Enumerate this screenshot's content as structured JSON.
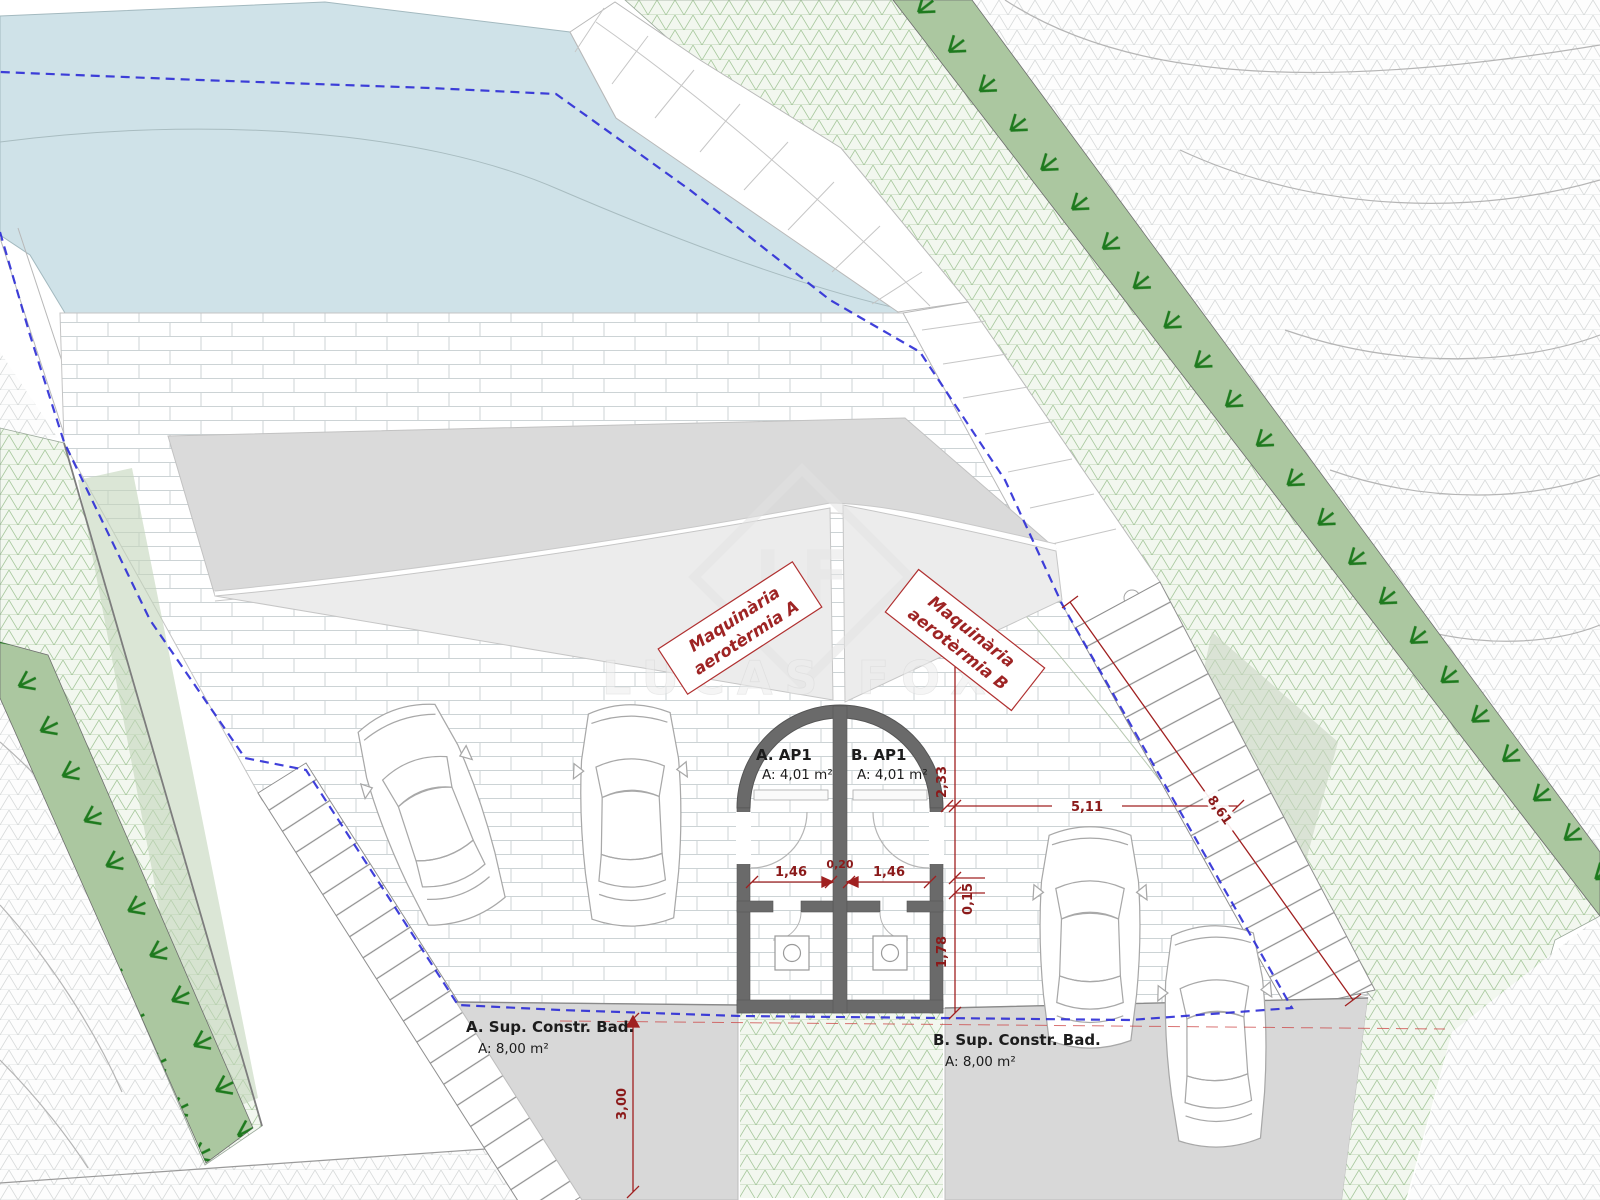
{
  "plan": {
    "watermark": {
      "logo": "LF",
      "brand": "LUCAS FOX"
    },
    "labels": {
      "machinery_a_line1": "Maquinària",
      "machinery_a_line2": "aerotèrmia A",
      "machinery_b_line1": "Maquinària",
      "machinery_b_line2": "aerotèrmia B",
      "room_a_name": "A. AP1",
      "room_a_area": "A: 4,01 m²",
      "room_b_name": "B. AP1",
      "room_b_area": "A: 4,01 m²",
      "surface_a_title": "A. Sup. Constr. Bad.",
      "surface_a_area": "A: 8,00 m²",
      "surface_b_title": "B. Sup. Constr. Bad.",
      "surface_b_area": "A: 8,00 m²"
    },
    "dimensions": {
      "terrace_width": "5,11",
      "stair_length": "8,61",
      "setback_depth": "2,33",
      "wall_gap": "0,15",
      "room_depth": "1,78",
      "room_a_width": "1,46",
      "wall_thickness": "0,20",
      "room_b_width": "1,46",
      "bottom_depth": "3,00"
    },
    "colors": {
      "pool": "#cfe2e8",
      "green_mesh_line": "#a6c89c",
      "green_mesh_bg": "#f2f7ef",
      "hedge_band": "#abc7a0",
      "hedge_feet": "#1e7a1e",
      "gray_mesh_line": "#d7dada",
      "ramp": "#dadada",
      "fan_zone": "#ececec",
      "surface_zone": "#d8d8d8",
      "wall": "#6a6a6a",
      "dimension_red": "#a02020",
      "boundary_blue": "#2b2bd6",
      "brick_joint": "#ccd3d5"
    }
  }
}
